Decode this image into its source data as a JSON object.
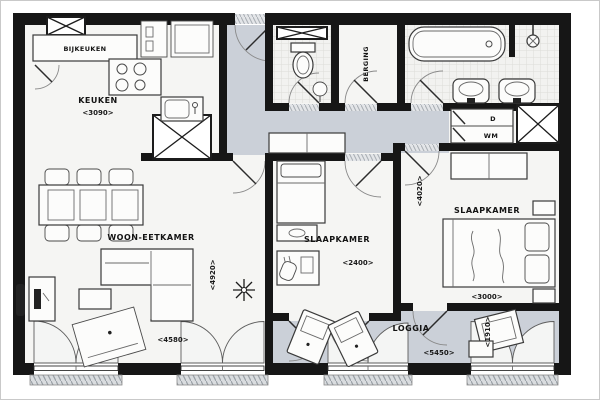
{
  "plan": {
    "type": "apartment-floor-plan",
    "rooms": {
      "bijkeuken": {
        "label": "BIJKEUKEN"
      },
      "keuken": {
        "label": "KEUKEN",
        "width": "<3090>"
      },
      "woon_eetkamer": {
        "label": "WOON-EETKAMER",
        "width": "<4580>",
        "depth": "<4920>"
      },
      "slaapkamer_1": {
        "label": "SLAAPKAMER",
        "width": "<2400>"
      },
      "slaapkamer_2": {
        "label": "SLAAPKAMER",
        "width": "<3000>",
        "depth": "<4020>"
      },
      "berging": {
        "label": "BERGING"
      },
      "loggia": {
        "label": "LOGGIA",
        "width": "<5450>",
        "depth": "<1910>"
      }
    },
    "appliances": {
      "dryer": "D",
      "washing_machine": "WM"
    },
    "colors": {
      "wall": "#161616",
      "room_floor": "#f5f5f3",
      "circulation_floor": "#cbd0d8",
      "furniture_line": "#3a3a3a"
    }
  }
}
